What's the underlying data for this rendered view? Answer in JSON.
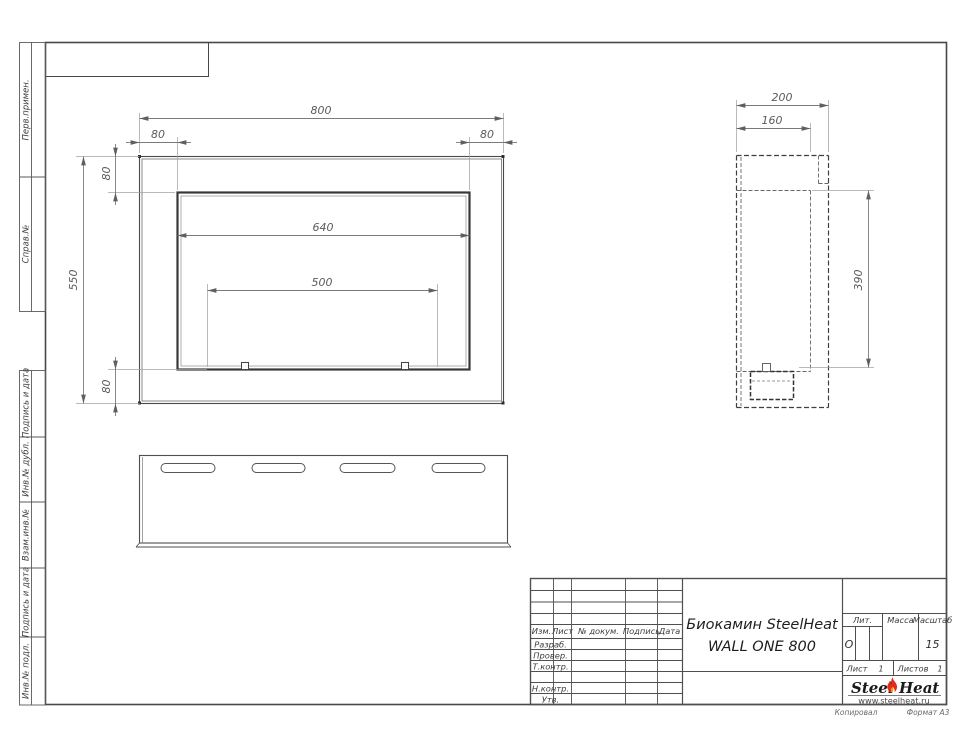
{
  "margin": {
    "perv": "Перв.примен.",
    "sprav": "Справ.№",
    "pd1": "Подпись и дата",
    "dubl": "Инв.№ дубл.",
    "vzam": "Взам.инв.№",
    "pd2": "Подпись и дата",
    "podl": "Инв.№ подл."
  },
  "tb": {
    "izm": "Изм.",
    "list_col": "Лист",
    "dok": "№ докум.",
    "podp": "Подпись",
    "data": "Дата",
    "razrab": "Разраб.",
    "prover": "Провер.",
    "tkontr": "Т.контр.",
    "nkontr": "Н.контр.",
    "utv": "Утв.",
    "title1": "Биокамин SteelHeat",
    "title2": "WALL ONE 800",
    "lit": "Лит.",
    "lit_val": "О",
    "massa": "Масса",
    "masshtab": "Масштаб",
    "masshtab_val": "15",
    "list": "Лист",
    "list_val": "1",
    "listov": "Листов",
    "listov_val": "1"
  },
  "logo": {
    "steel": "Steel",
    "heat": "Heat",
    "url": "www.steelheat.ru"
  },
  "footer": {
    "kopiroval": "Копировал",
    "format": "Формат А3"
  },
  "dims": {
    "front": {
      "total_width": "800",
      "left_offset": "80",
      "right_offset": "80",
      "top_offset": "80",
      "total_height": "550",
      "opening_width": "640",
      "burner_width": "500",
      "bottom_offset": "80"
    },
    "side": {
      "total_depth": "200",
      "inner_depth": "160",
      "opening_height": "390"
    }
  },
  "colors": {
    "outline": "#4a4a4a",
    "dim_line": "#9a9a9a",
    "dim_text": "#5a5a5a",
    "flame_red": "#e32b1d",
    "flame_orange": "#f59b00"
  }
}
